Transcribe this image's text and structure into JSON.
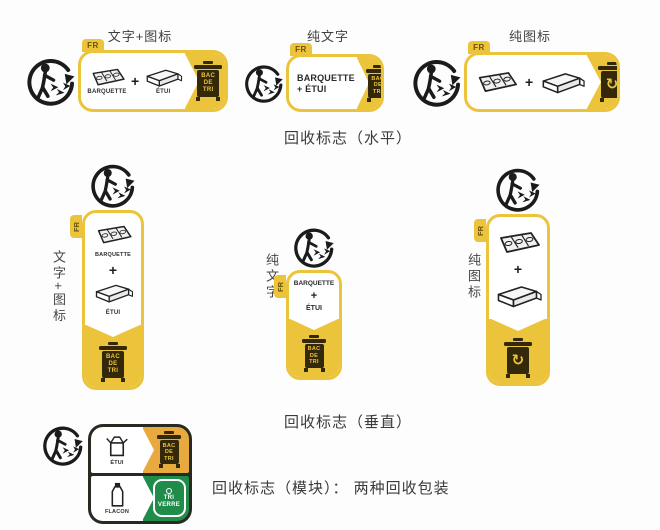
{
  "headers": {
    "text_icon": "文字+图标",
    "text_only": "纯文字",
    "icon_only": "纯图标"
  },
  "side_labels": {
    "text_icon": "文字+图标",
    "text_only": "纯文字",
    "icon_only": "纯图标"
  },
  "captions": {
    "horizontal": "回收标志（水平）",
    "vertical": "回收标志（垂直）",
    "module": "回收标志（模块）： 两种回收包装"
  },
  "texts": {
    "fr": "FR",
    "barquette": "BARQUETTE",
    "etui": "ÉTUI",
    "flacon": "FLACON",
    "plus": "+",
    "plus_etui": "+ ÉTUI",
    "bin_lines": [
      "BAC",
      "DE",
      "TRI"
    ],
    "tri_verre_lines": [
      "TRI",
      "VERRE"
    ]
  },
  "icons": {
    "recycle_arrow": "↻"
  },
  "colors": {
    "label_yellow": "#ecc43c",
    "module_amber": "#e8a93e",
    "module_green": "#1f8c4a",
    "bin_dark": "#33290a"
  }
}
